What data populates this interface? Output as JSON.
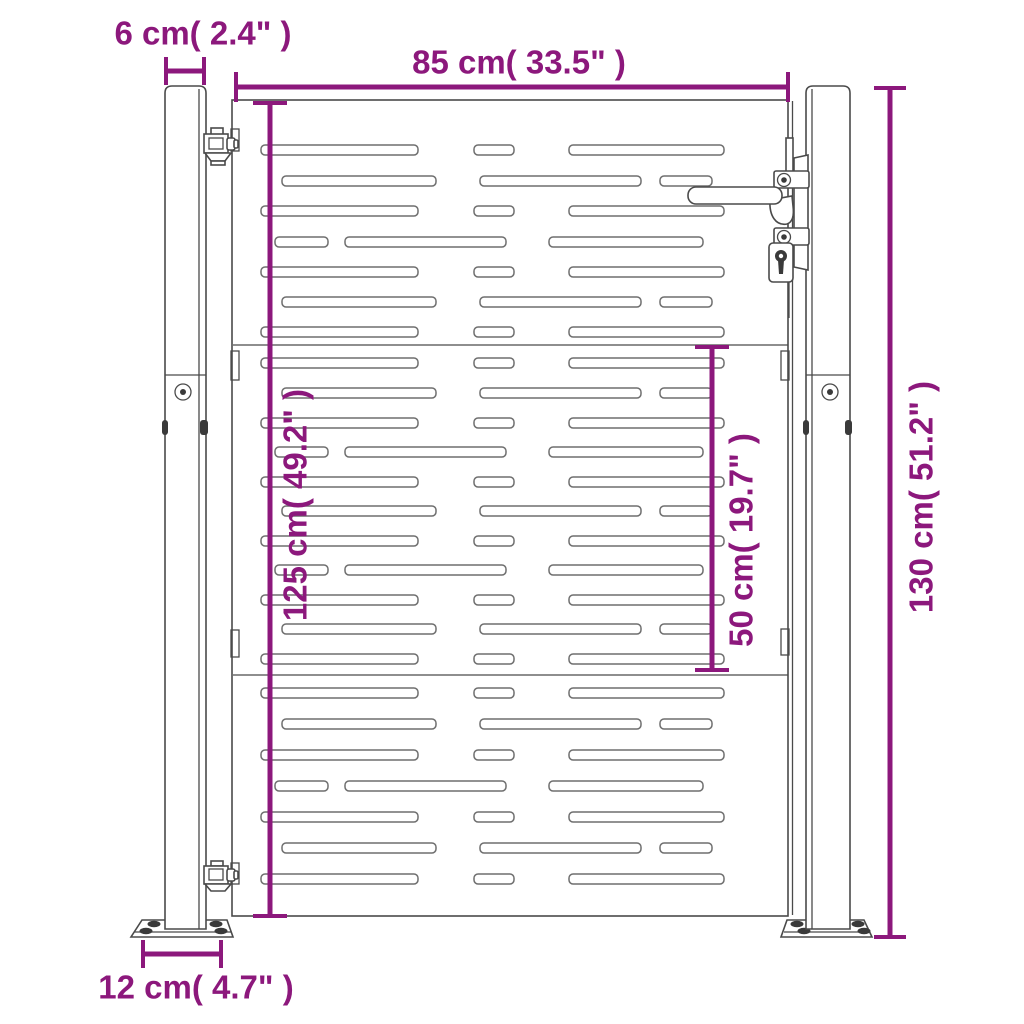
{
  "colors": {
    "accent": "#8C187C",
    "outline": "#4A4A4A",
    "slot_outline": "#6E6E6E",
    "bolt_fill": "#3A3A3A",
    "background": "#FFFFFF"
  },
  "dimensions": {
    "post_width": {
      "label": "6 cm( 2.4\" )",
      "cm": 6,
      "inch": 2.4
    },
    "gate_width": {
      "label": "85 cm( 33.5\" )",
      "cm": 85,
      "inch": 33.5
    },
    "total_height": {
      "label": "130 cm( 51.2\" )",
      "cm": 130,
      "inch": 51.2
    },
    "gate_height": {
      "label": "125 cm( 49.2\" )",
      "cm": 125,
      "inch": 49.2
    },
    "mid_section_height": {
      "label": "50 cm( 19.7\" )",
      "cm": 50,
      "inch": 19.7
    },
    "base_plate_width": {
      "label": "12 cm( 4.7\" )",
      "cm": 12,
      "inch": 4.7
    }
  },
  "gate": {
    "panel": {
      "x": 232,
      "y": 100,
      "width": 556,
      "height": 816
    },
    "section_seams_y": [
      345,
      675
    ],
    "slot_height": 10,
    "slot_patterns": {
      "A": [
        [
          29,
          157
        ],
        [
          242,
          40
        ],
        [
          337,
          155
        ]
      ],
      "B": [
        [
          50,
          154
        ],
        [
          248,
          161
        ],
        [
          428,
          52
        ]
      ],
      "C": [
        [
          43,
          53
        ],
        [
          113,
          161
        ],
        [
          317,
          154
        ]
      ]
    },
    "slot_rows": [
      {
        "y": 145,
        "pattern": "A"
      },
      {
        "y": 176,
        "pattern": "B"
      },
      {
        "y": 206,
        "pattern": "A"
      },
      {
        "y": 237,
        "pattern": "C"
      },
      {
        "y": 267,
        "pattern": "A"
      },
      {
        "y": 297,
        "pattern": "B"
      },
      {
        "y": 327,
        "pattern": "A"
      },
      {
        "y": 358,
        "pattern": "A"
      },
      {
        "y": 388,
        "pattern": "B"
      },
      {
        "y": 418,
        "pattern": "A"
      },
      {
        "y": 447,
        "pattern": "C"
      },
      {
        "y": 477,
        "pattern": "A"
      },
      {
        "y": 506,
        "pattern": "B"
      },
      {
        "y": 536,
        "pattern": "A"
      },
      {
        "y": 565,
        "pattern": "C"
      },
      {
        "y": 595,
        "pattern": "A"
      },
      {
        "y": 624,
        "pattern": "B"
      },
      {
        "y": 654,
        "pattern": "A"
      },
      {
        "y": 688,
        "pattern": "A"
      },
      {
        "y": 719,
        "pattern": "B"
      },
      {
        "y": 750,
        "pattern": "A"
      },
      {
        "y": 781,
        "pattern": "C"
      },
      {
        "y": 812,
        "pattern": "A"
      },
      {
        "y": 843,
        "pattern": "B"
      },
      {
        "y": 874,
        "pattern": "A"
      }
    ]
  }
}
